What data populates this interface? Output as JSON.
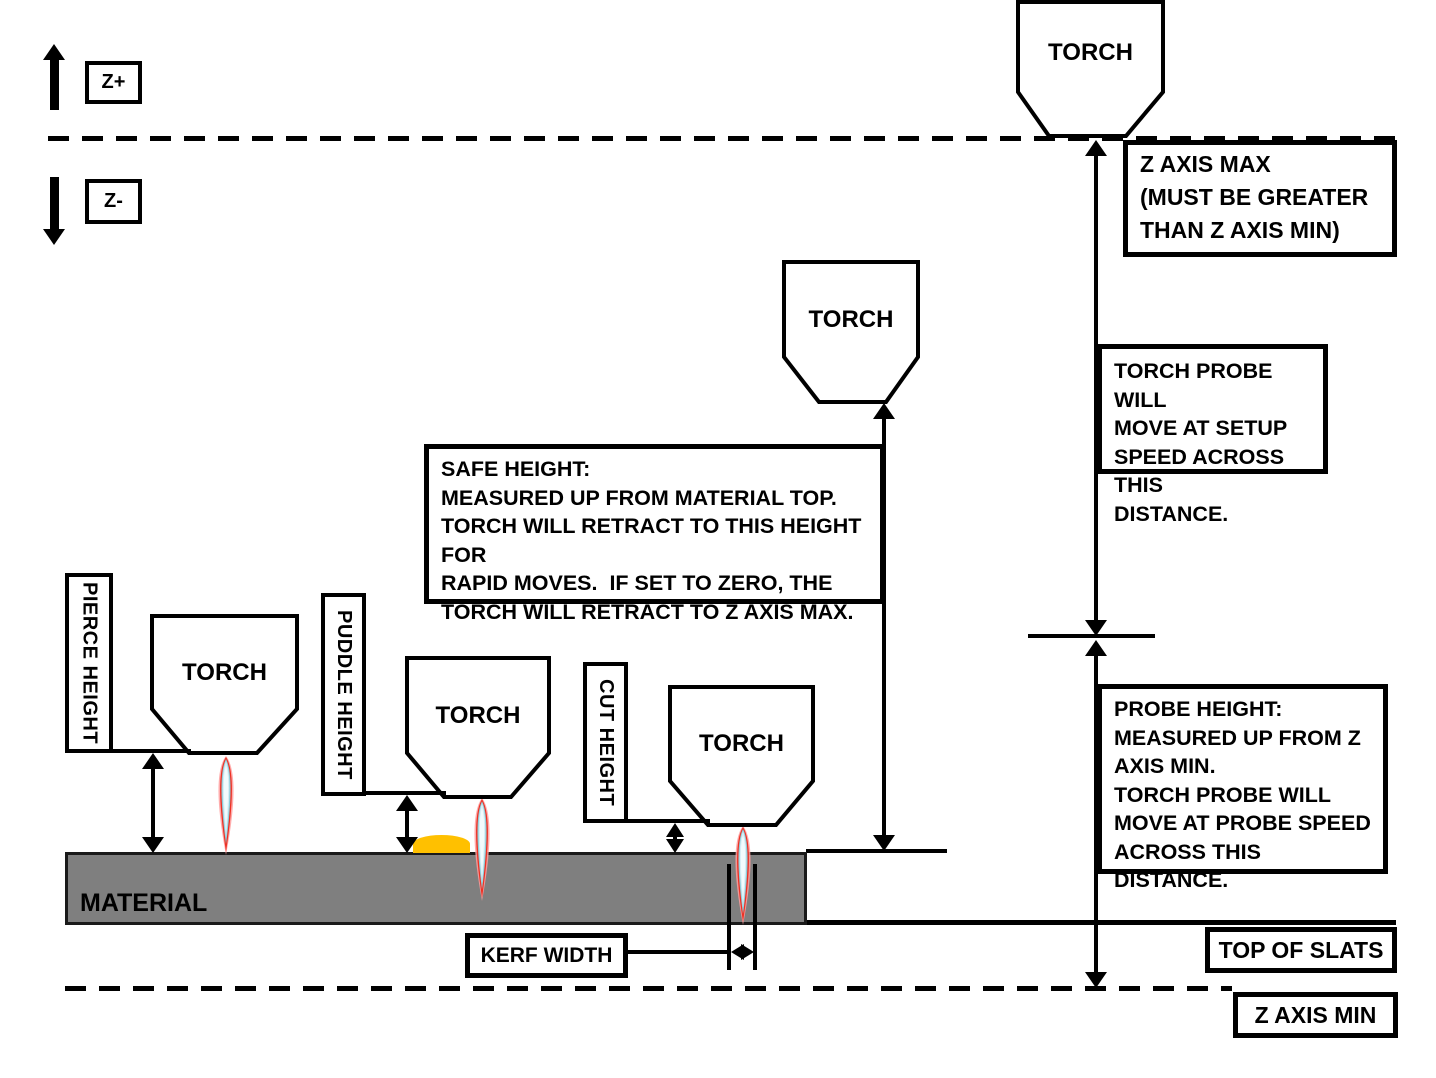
{
  "labels": {
    "z_plus": "Z+",
    "z_minus": "Z-",
    "torch": "TORCH",
    "material": "MATERIAL",
    "kerf_width": "KERF WIDTH",
    "top_of_slats": "TOP OF SLATS",
    "z_axis_min": "Z AXIS MIN",
    "pierce_height": "PIERCE HEIGHT",
    "puddle_height": "PUDDLE HEIGHT",
    "cut_height": "CUT HEIGHT"
  },
  "notes": {
    "z_axis_max": "Z AXIS MAX\n(MUST BE GREATER\nTHAN Z AXIS MIN)",
    "setup_speed": "TORCH PROBE WILL\nMOVE AT SETUP\nSPEED ACROSS THIS\nDISTANCE.",
    "safe_height": "SAFE HEIGHT:\nMEASURED UP FROM MATERIAL TOP.\nTORCH WILL RETRACT TO THIS HEIGHT FOR\nRAPID MOVES.  IF SET TO ZERO, THE\nTORCH WILL RETRACT TO Z AXIS MAX.",
    "probe_height": "PROBE HEIGHT:\nMEASURED UP FROM Z\nAXIS MIN.\nTORCH PROBE WILL\nMOVE AT PROBE SPEED\nACROSS THIS DISTANCE."
  },
  "colors": {
    "line": "#000000",
    "material_fill": "#7f7f7f",
    "puddle_fill": "#ffc000",
    "flame_glow": "#ff9d9d",
    "flame_red": "#ee3124",
    "flame_teal": "#8ccdd9",
    "flame_blue": "#d4edf4",
    "flame_core": "#f2fbfd"
  }
}
